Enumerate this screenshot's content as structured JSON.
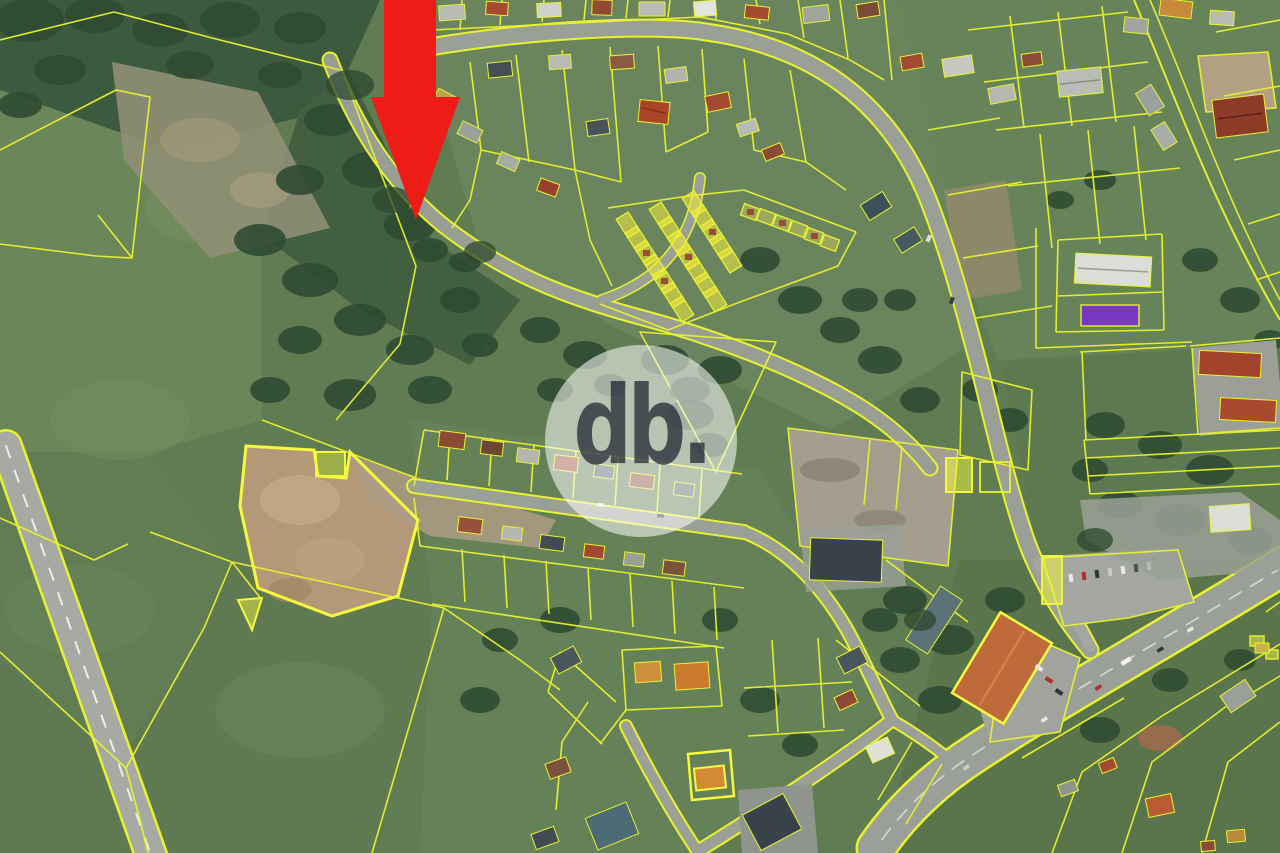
{
  "watermark": {
    "text": "db."
  },
  "marker": {
    "kind": "location-arrow",
    "direction": "down"
  },
  "colors": {
    "marker_red": "#ed1c16",
    "cadastral_line": "#e9f22e",
    "cadastral_highlight": "#f6fa3c",
    "selected_parcel_purple": "#7b2bd6",
    "allotment_fill": "#f4ee3c",
    "road_gray": "#9aa096",
    "field_green": "#5f7c52"
  }
}
